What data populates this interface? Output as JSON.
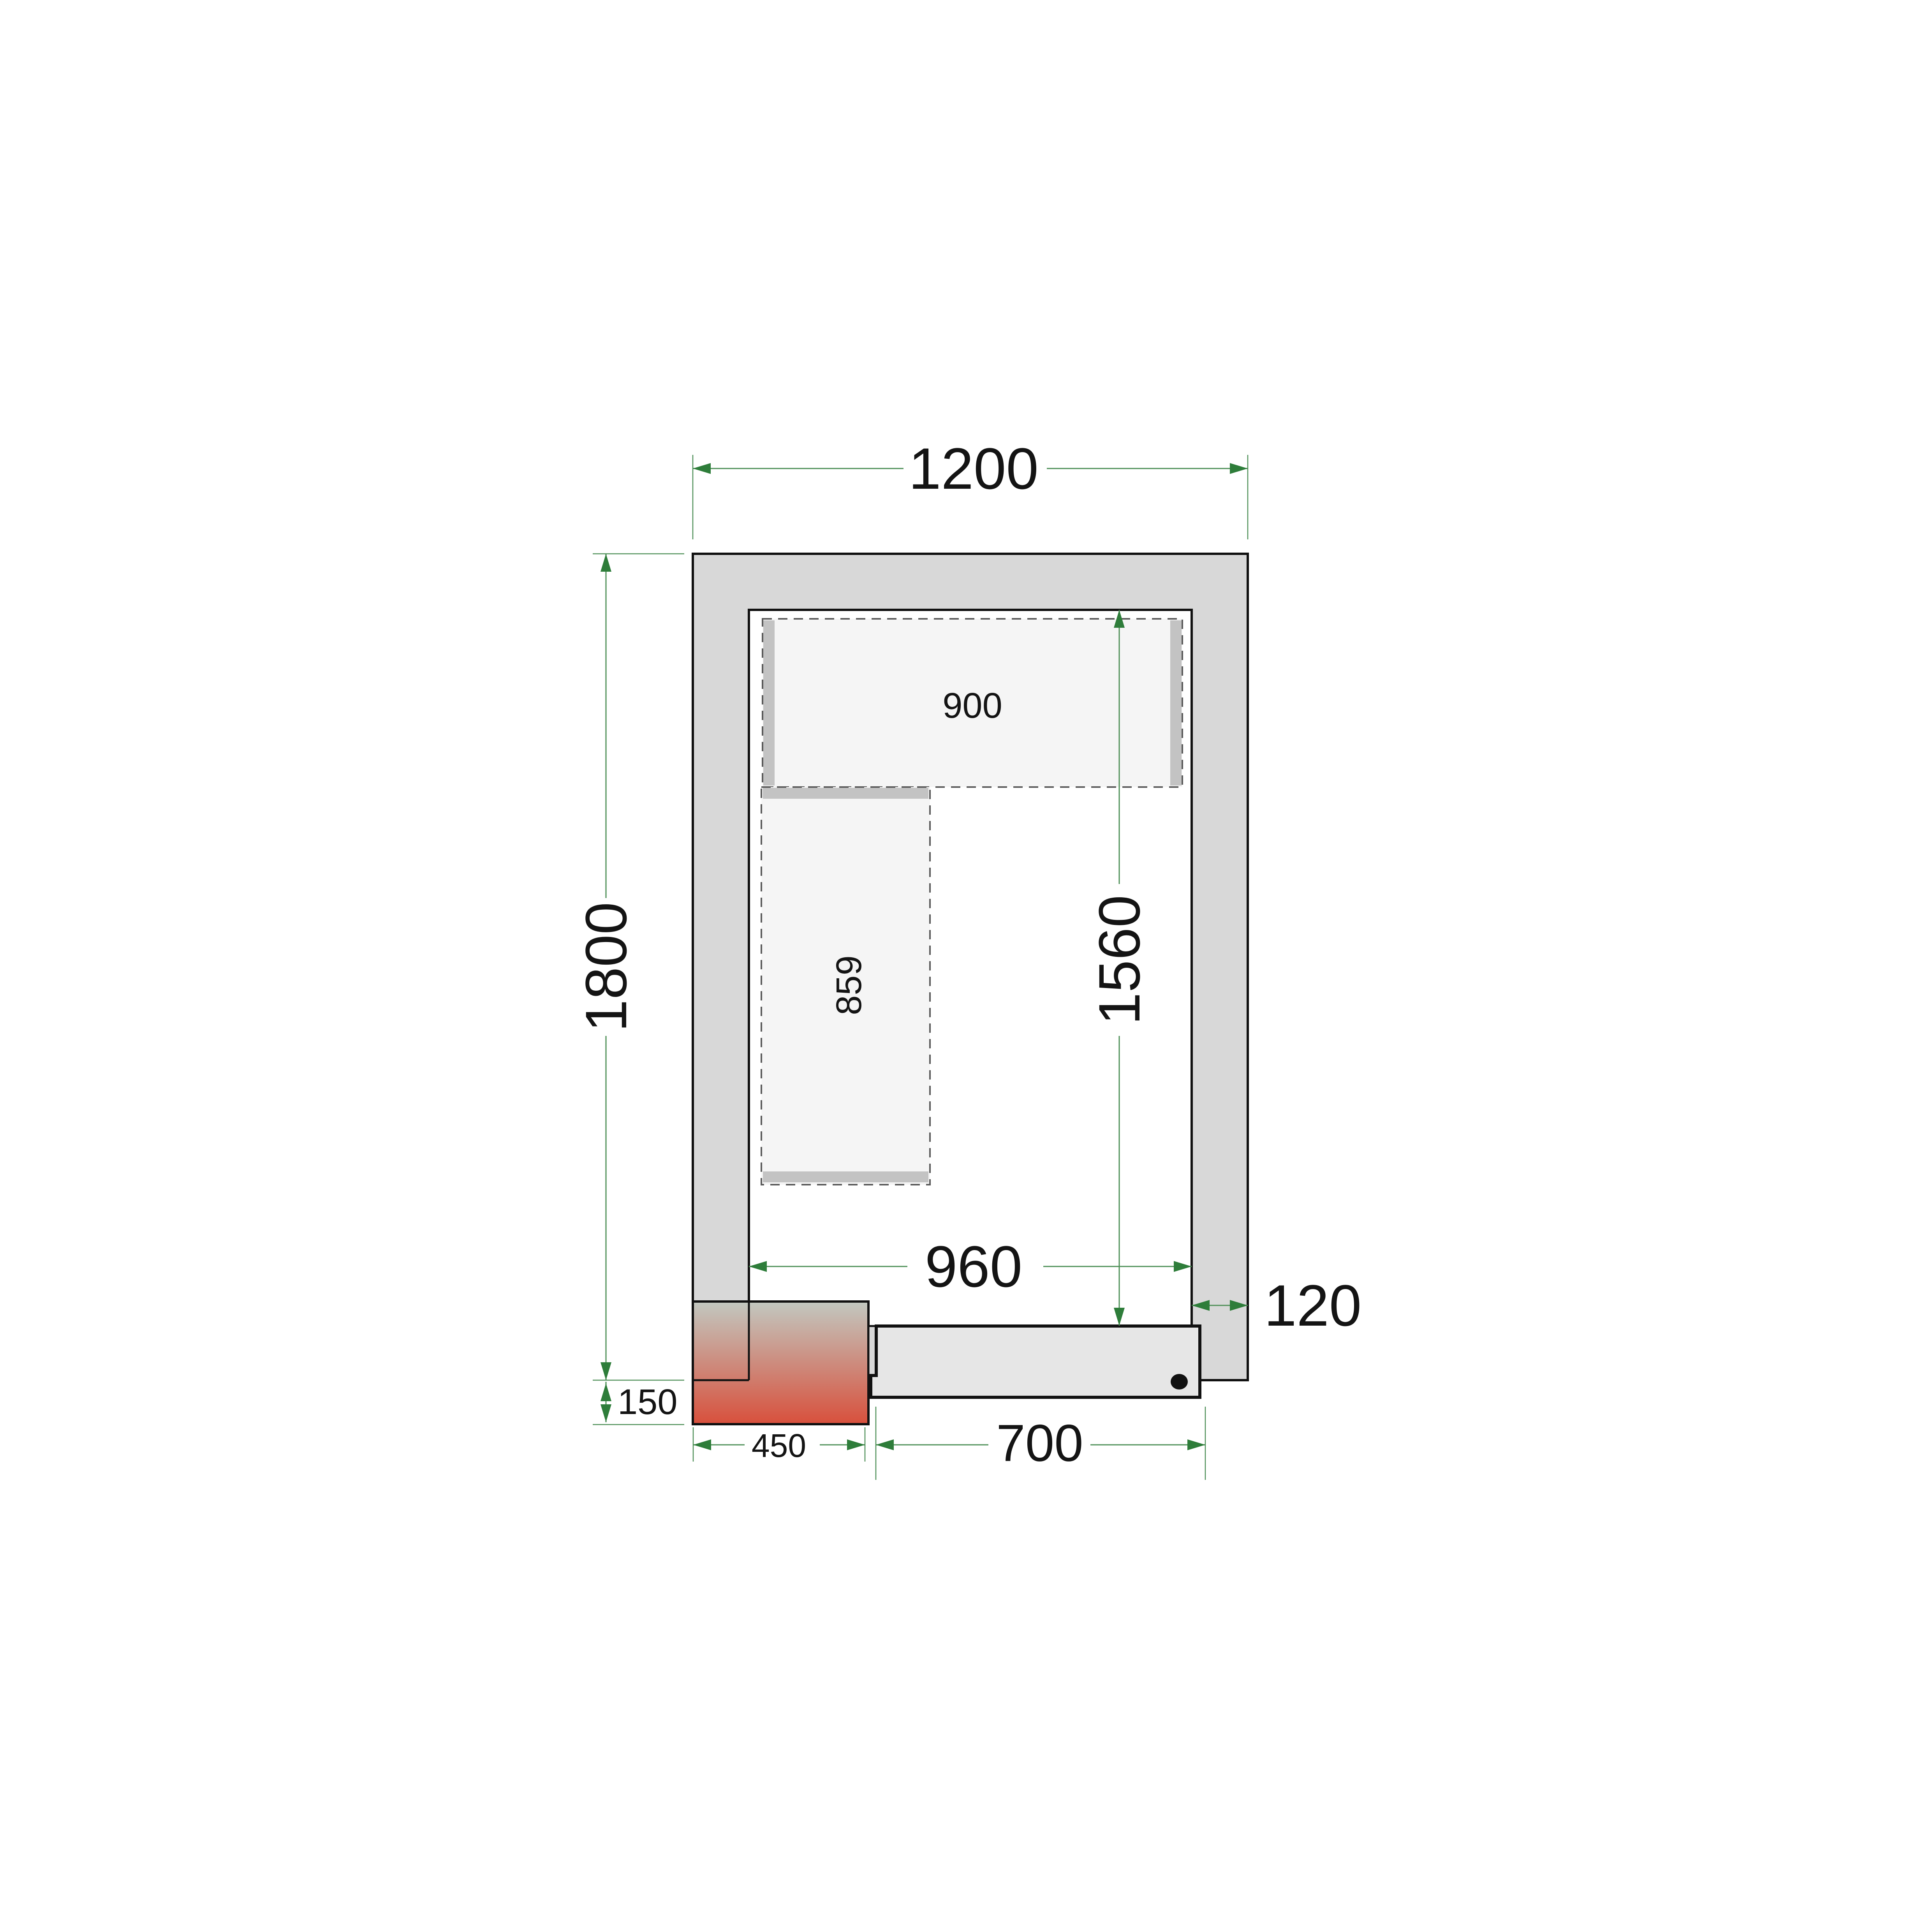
{
  "diagram": {
    "title": "cold-room-floor-plan",
    "labels": {
      "outer_width": "1200",
      "outer_depth": "1800",
      "inner_depth": "1560",
      "inner_width": "960",
      "wall_thickness": "120",
      "unit_offset": "150",
      "unit_width": "450",
      "door_width": "700",
      "top_shelf": "900",
      "side_shelf": "859"
    },
    "colors": {
      "dimension_arrow": "#2e7d3a",
      "dimension_line": "#4f9058",
      "wall_fill": "#d8d8d8",
      "outline": "#111111",
      "shelf_fill": "#f5f5f5",
      "shelf_bar": "#c3c3c3",
      "shelf_dash": "#5a5a5a",
      "door_fill": "#e6e6e6",
      "unit_gradient_top": "#c2c8c0",
      "unit_gradient_bottom": "#d8503c",
      "label_text": "#141414",
      "background": "#ffffff"
    }
  }
}
